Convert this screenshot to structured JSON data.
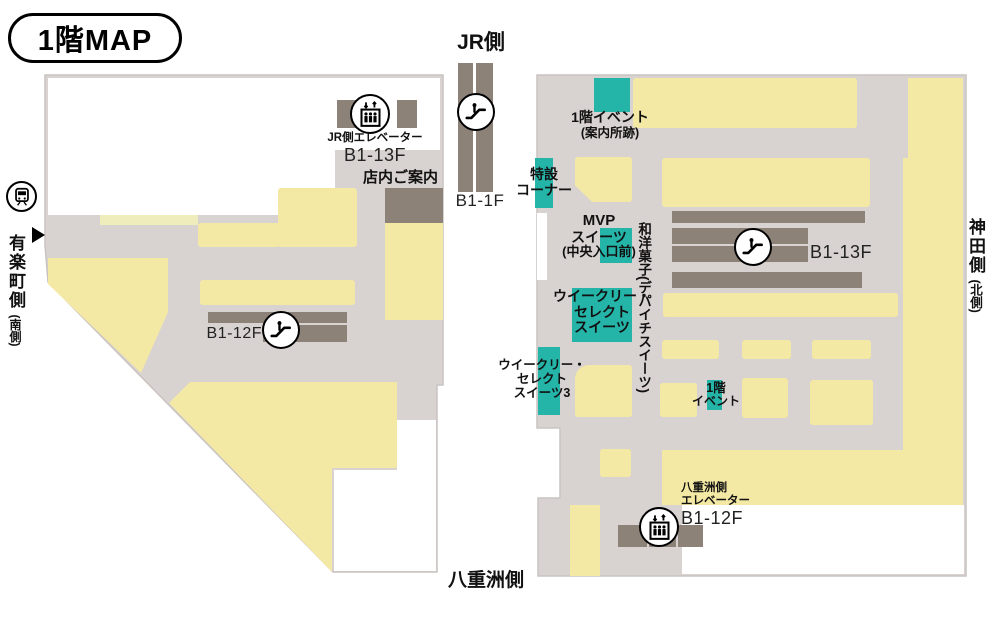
{
  "title": "1階MAP",
  "colors": {
    "teal": "#25b4a8",
    "yellow": "#f4e9a4",
    "pale_yellow": "#f0edbd",
    "building_gray": "#d8d2d0",
    "bar_gray": "#8d8278"
  },
  "directions": {
    "jr": "JR側",
    "yaesu": "八重洲側",
    "yurakucho": "有楽町側",
    "yurakucho_sub": "(南側)",
    "kanda": "神田側",
    "kanda_sub": "(北側)"
  },
  "left_building": {
    "jr_elevator_label": "JR側エレベーター",
    "jr_elevator_floors": "B1-13F",
    "store_info": "店内ご案内",
    "escalator_floors": "B1-12F"
  },
  "jr_escalator": {
    "floors": "B1-1F"
  },
  "right_building": {
    "event_1f_top": {
      "line1": "1階イベント",
      "line2": "(案内所跡)"
    },
    "special_corner": {
      "line1": "特設",
      "line2": "コーナー"
    },
    "mvp_sweets": {
      "line1": "MVP",
      "line2": "スイーツ",
      "line3": "(中央入口前)"
    },
    "wayo_kashi": "和洋菓子(デパイチスイーツ)",
    "weekly_select": {
      "line1": "ウイークリー・",
      "line2": "セレクト",
      "line3": "スイーツ"
    },
    "weekly_select_3": {
      "line1": "ウイークリー・",
      "line2": "セレクト",
      "line3": "スイーツ3"
    },
    "event_1f_small": {
      "line1": "1階",
      "line2": "イベント"
    },
    "escalator_floors": "B1-13F",
    "yaesu_elevator": {
      "line1": "八重洲側",
      "line2": "エレベーター",
      "floors": "B1-12F"
    }
  }
}
